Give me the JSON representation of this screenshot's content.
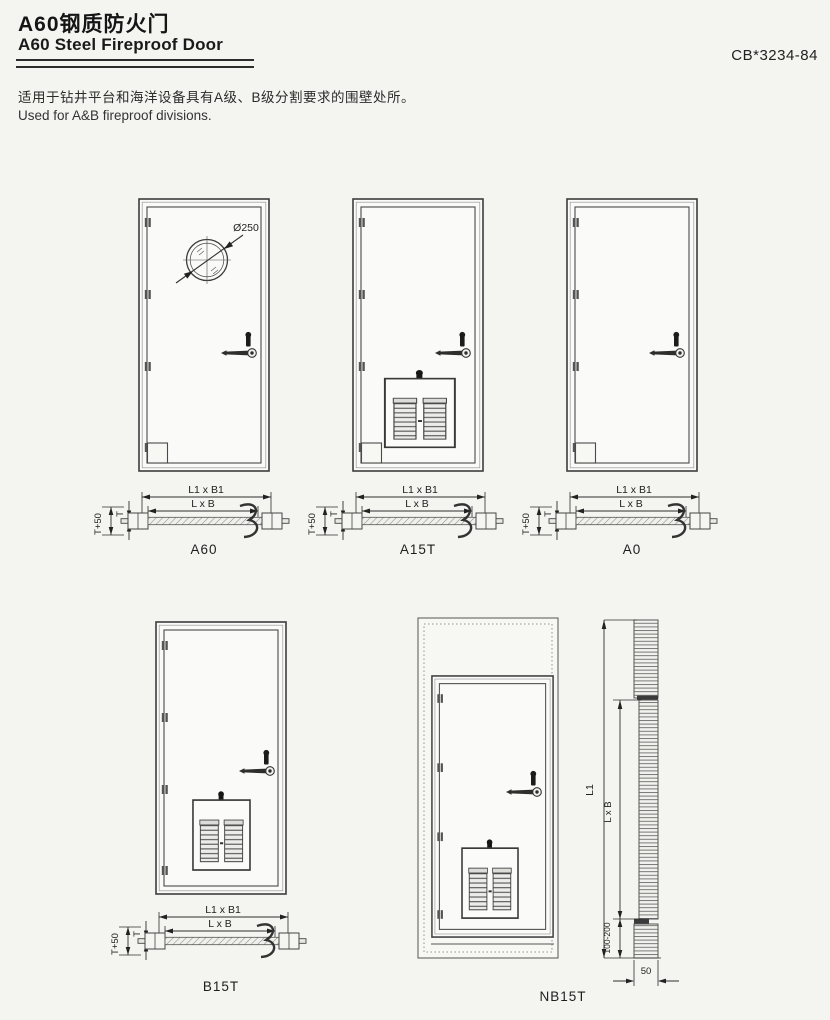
{
  "page": {
    "background": "#f4f4f1",
    "line_color": "#3f3f3f"
  },
  "header": {
    "title_zh": "A60钢质防火门",
    "title_en": "A60 Steel Fireproof Door",
    "standard_code": "CB*3234-84"
  },
  "intro": {
    "zh": "适用于钻井平台和海洋设备具有A级、B级分割要求的围壁处所。",
    "en": "Used for A&B fireproof divisions."
  },
  "dims": {
    "outer": "L1 x B1",
    "inner": "L x B",
    "frame_height": "T+50",
    "thickness": "T",
    "porthole_diameter": "Ø250",
    "overall_height": "L1",
    "opening": "L x B",
    "bottom_gap": "100-200",
    "sill_width": "50"
  },
  "doors": [
    {
      "label": "A60"
    },
    {
      "label": "A15T"
    },
    {
      "label": "A0"
    },
    {
      "label": "B15T"
    },
    {
      "label": "NB15T"
    }
  ]
}
